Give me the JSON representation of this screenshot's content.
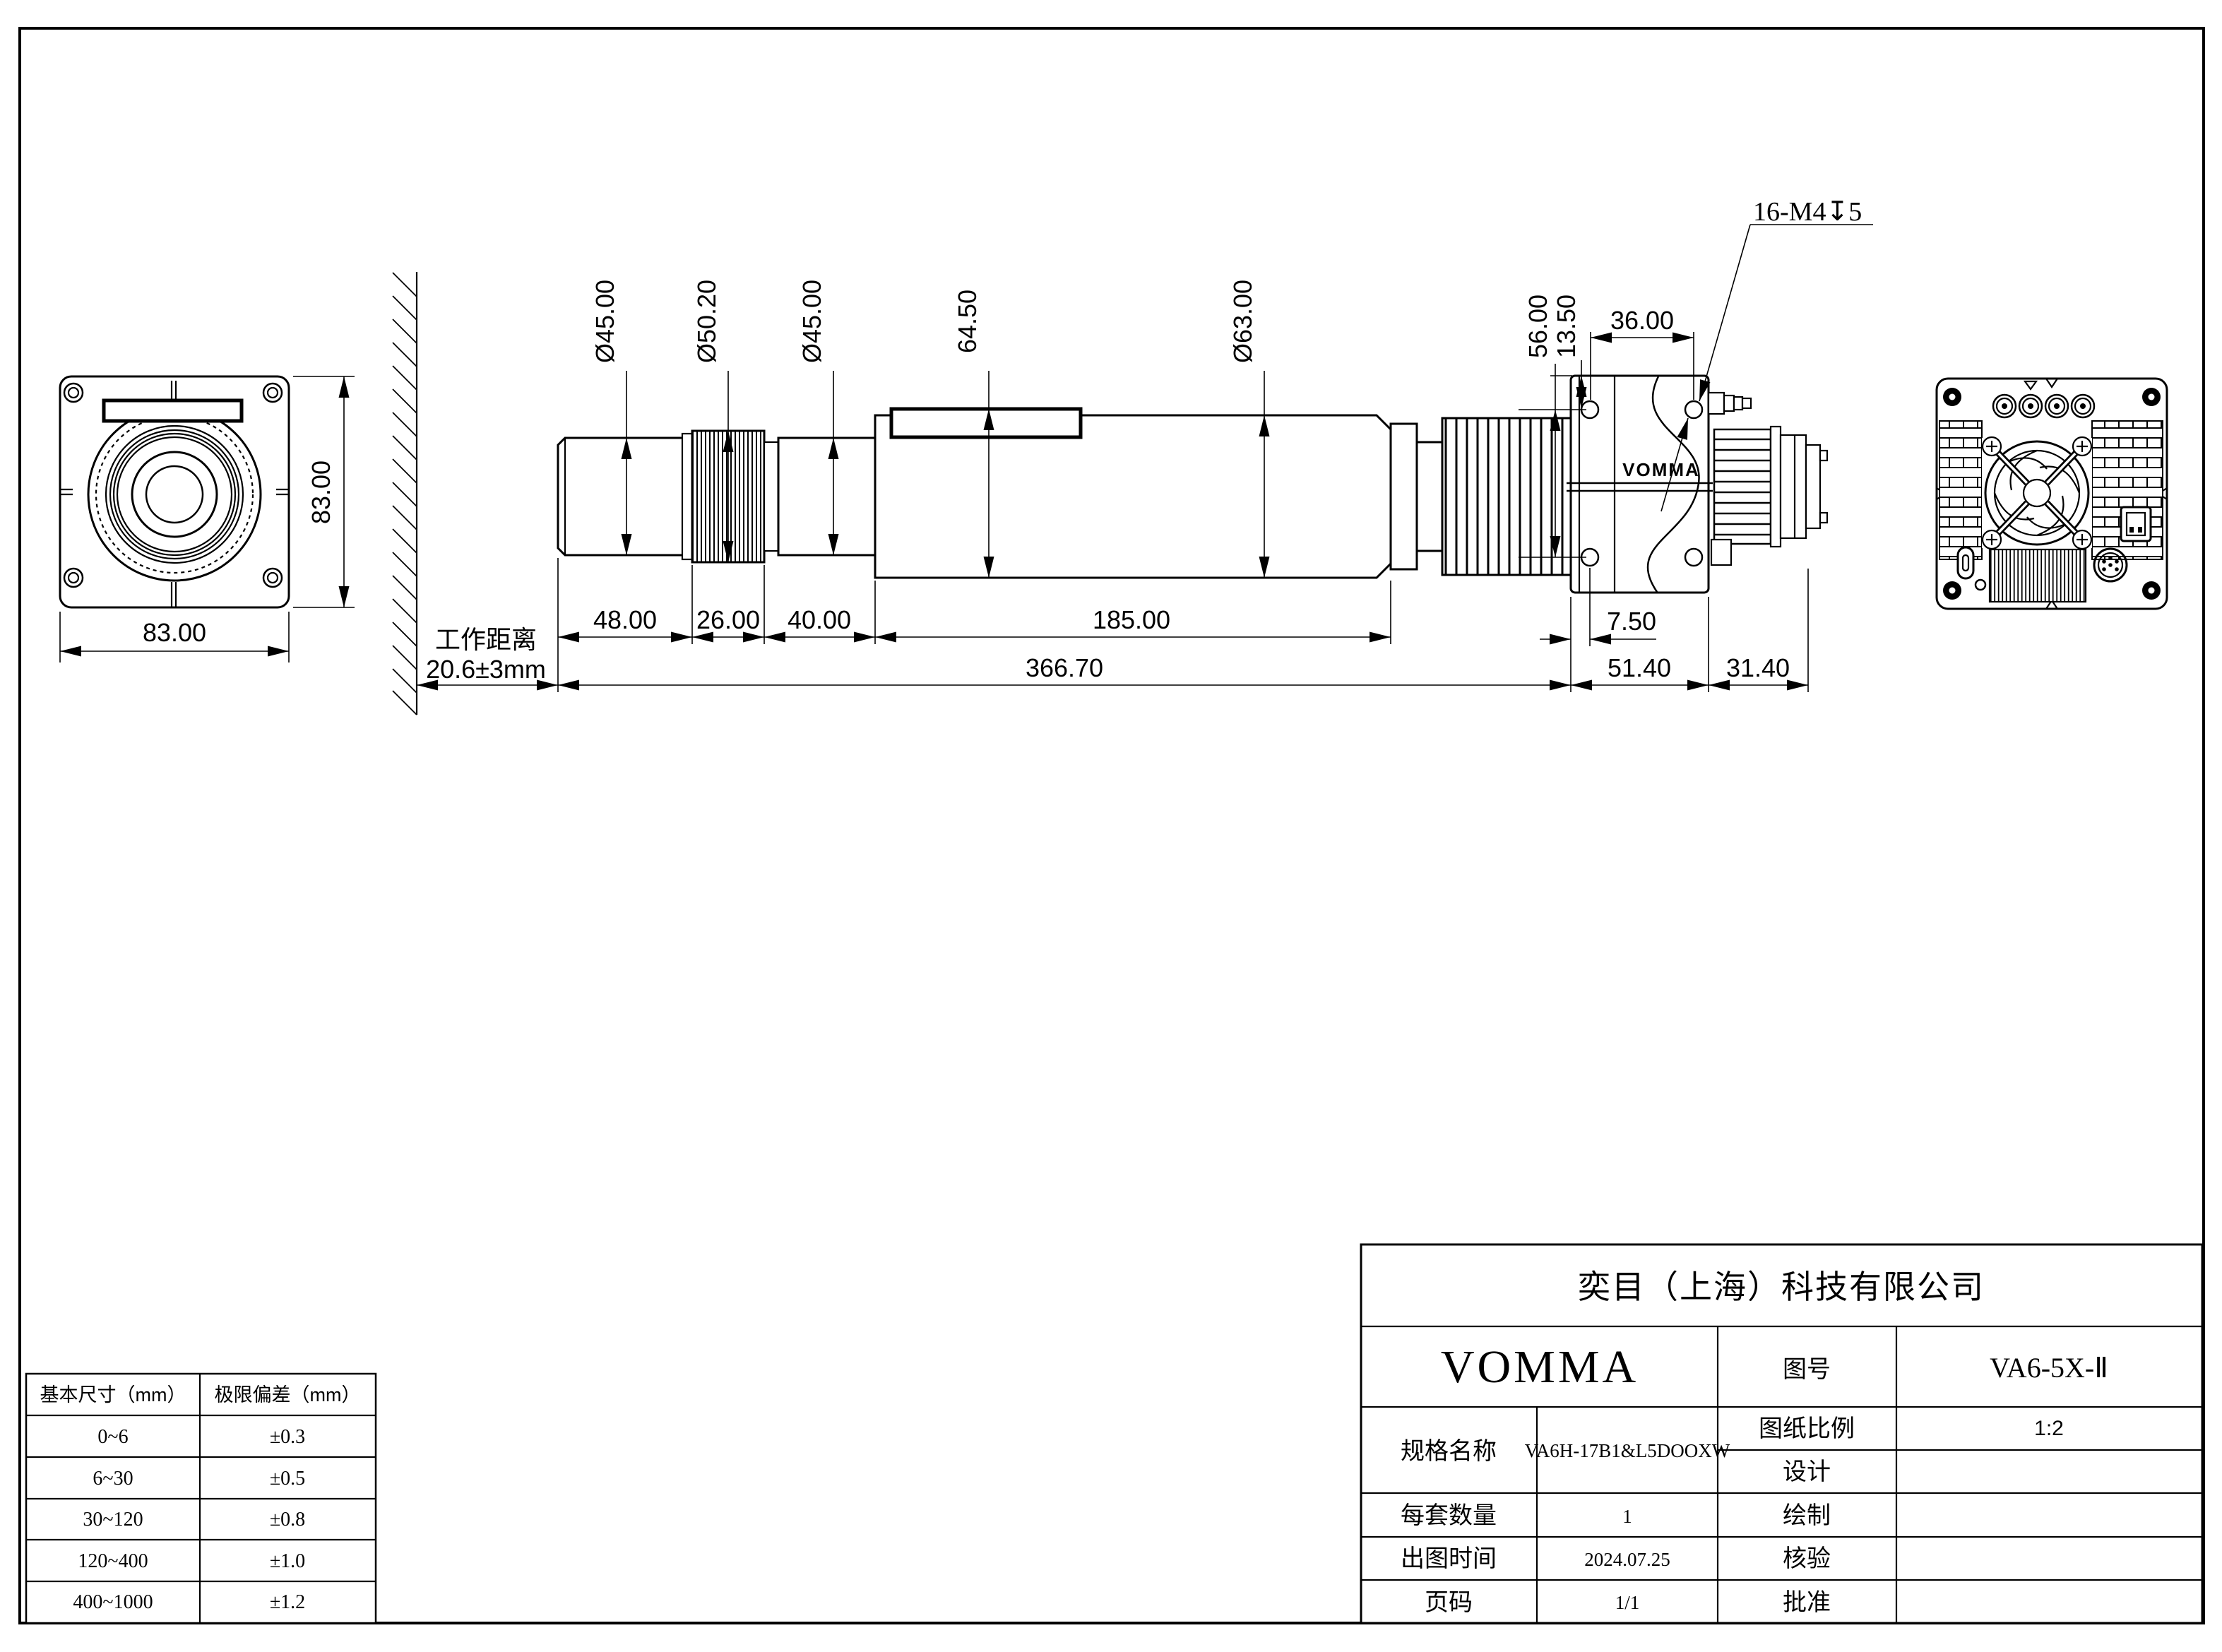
{
  "front_view": {
    "width_dim": "83.00",
    "height_dim": "83.00"
  },
  "side_view": {
    "wd_label": "工作距离",
    "wd_value": "20.6±3mm",
    "dia_front": "Ø45.00",
    "dia_ring": "Ø50.20",
    "dia_mid": "Ø45.00",
    "body_height": "64.50",
    "dia_body": "Ø63.00",
    "seg_front": "48.00",
    "seg_ring": "26.00",
    "seg_mid": "40.00",
    "seg_body": "185.00",
    "total_len": "366.70",
    "hole_top_offset": "13.50",
    "hole_span_v": "56.00",
    "hole_span_h": "36.00",
    "thread_callout": "16-M4↧5",
    "hole_left_offset": "7.50",
    "head_len": "51.40",
    "rear_len": "31.40",
    "logo": "VOMMA"
  },
  "tolerance_table": {
    "headers": {
      "size": "基本尺寸（mm）",
      "tol": "极限偏差（mm）"
    },
    "rows": [
      {
        "size": "0~6",
        "tol": "±0.3"
      },
      {
        "size": "6~30",
        "tol": "±0.5"
      },
      {
        "size": "30~120",
        "tol": "±0.8"
      },
      {
        "size": "120~400",
        "tol": "±1.0"
      },
      {
        "size": "400~1000",
        "tol": "±1.2"
      }
    ]
  },
  "title_block": {
    "company": "奕目（上海）科技有限公司",
    "brand": "VOMMA",
    "drawing_no_label": "图号",
    "drawing_no": "VA6-5X-Ⅱ",
    "spec_label": "规格名称",
    "spec_value": "VA6H-17B1&L5DOOXW",
    "scale_label": "图纸比例",
    "scale_value": "1:2",
    "design_label": "设计",
    "qty_label": "每套数量",
    "qty_value": "1",
    "draft_label": "绘制",
    "date_label": "出图时间",
    "date_value": "2024.07.25",
    "verify_label": "核验",
    "page_label": "页码",
    "page_value": "1/1",
    "approve_label": "批准"
  }
}
